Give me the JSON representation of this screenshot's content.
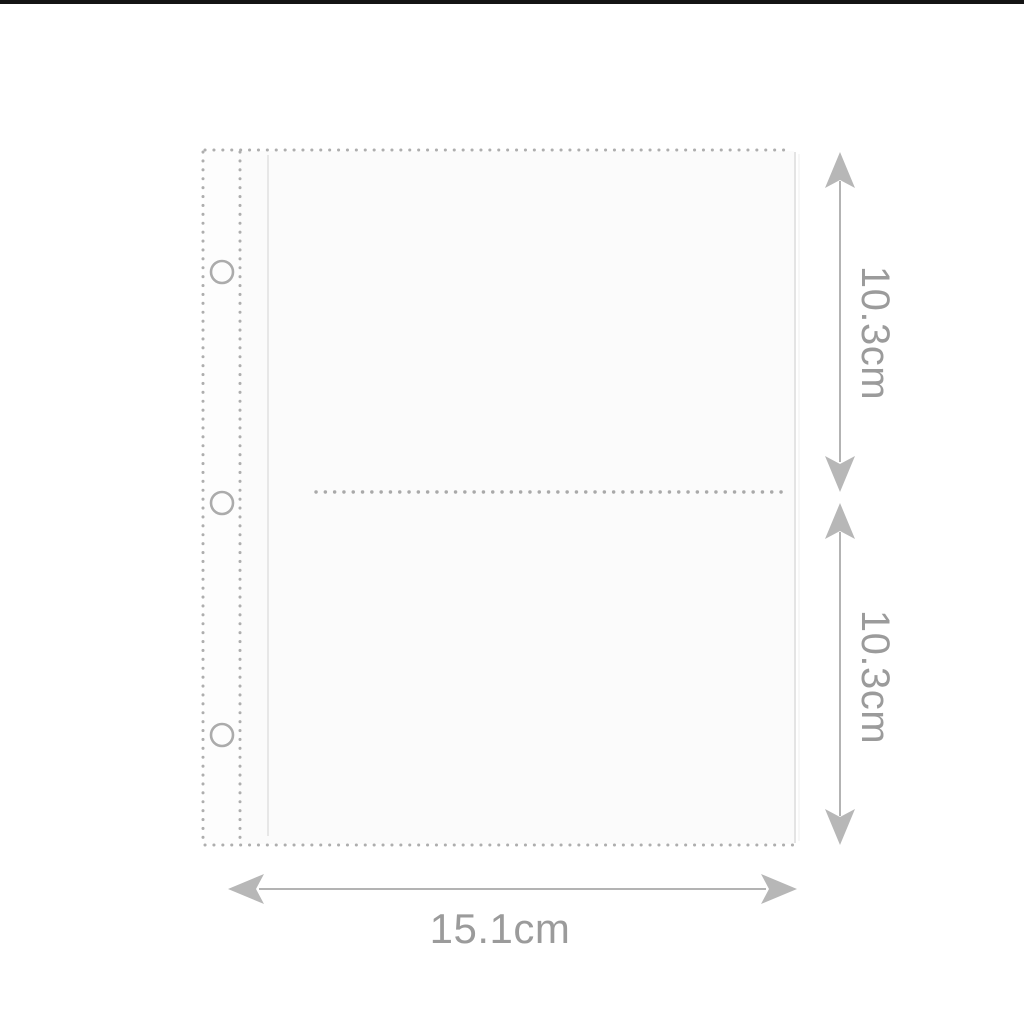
{
  "page": {
    "background_color": "#ffffff",
    "top_bar_color": "#141414"
  },
  "diagram": {
    "subject": "transparent binder sleeve page with two photo pockets",
    "sleeve": {
      "pocket_count": 2,
      "binder_hole_count": 3
    },
    "dimensions": {
      "pocket_height_top": "10.3cm",
      "pocket_height_bottom": "10.3cm",
      "width": "15.1cm"
    },
    "colors": {
      "dotted_seam": "#aeaeae",
      "arrow": "#b7b7b7",
      "dimension_text": "#9b9b9b",
      "sleeve_fill": "#fbfbfb",
      "sleeve_right_edge": "#dddddd",
      "top_bar": "#141414"
    }
  }
}
